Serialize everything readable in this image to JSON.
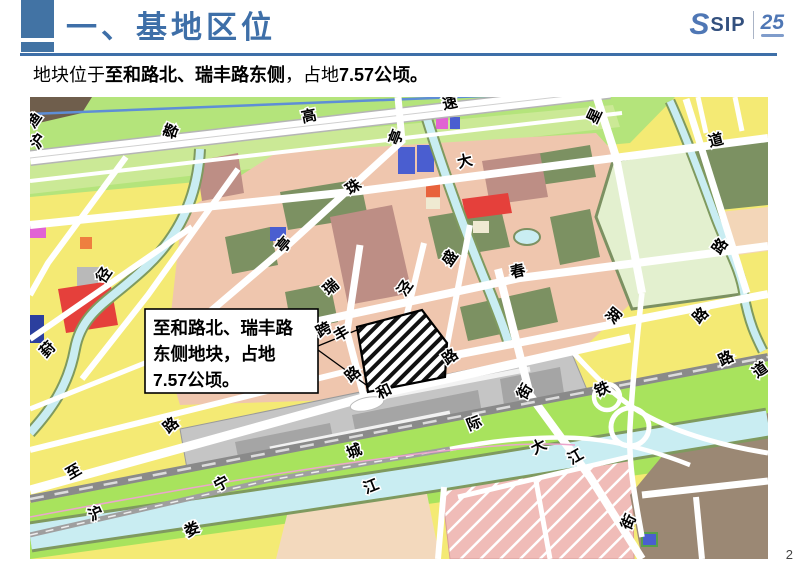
{
  "header": {
    "title": "一、基地区位"
  },
  "logo": {
    "s_mark": "S",
    "name": "SIP",
    "anniversary": "25"
  },
  "intro": {
    "prefix": "地块位于",
    "location": "至和路北、瑞丰路东侧",
    "mid": "，占地",
    "area": "7.57公顷。"
  },
  "callout": {
    "lines": [
      "至和路北、瑞丰路",
      "东侧地块，占地",
      "7.57公顷。"
    ]
  },
  "map": {
    "labels": [
      {
        "t": "渔",
        "x": 8,
        "y": 26,
        "r": -55
      },
      {
        "t": "沪",
        "x": 12,
        "y": 47,
        "r": -55
      },
      {
        "t": "蓉",
        "x": 146,
        "y": 36,
        "r": -70
      },
      {
        "t": "高",
        "x": 280,
        "y": 24,
        "r": -12
      },
      {
        "t": "速",
        "x": 421,
        "y": 11,
        "r": -12
      },
      {
        "t": "亭",
        "x": 371,
        "y": 42,
        "r": -70
      },
      {
        "t": "星",
        "x": 569,
        "y": 21,
        "r": -65
      },
      {
        "t": "大",
        "x": 436,
        "y": 69,
        "r": -14
      },
      {
        "t": "道",
        "x": 687,
        "y": 48,
        "r": -14
      },
      {
        "t": "珠",
        "x": 326,
        "y": 94,
        "r": -35
      },
      {
        "t": "径",
        "x": 78,
        "y": 181,
        "r": -55
      },
      {
        "t": "亭",
        "x": 258,
        "y": 151,
        "r": -50
      },
      {
        "t": "盛",
        "x": 424,
        "y": 164,
        "r": -55
      },
      {
        "t": "春",
        "x": 489,
        "y": 179,
        "r": -14
      },
      {
        "t": "瑞",
        "x": 304,
        "y": 194,
        "r": -40
      },
      {
        "t": "泾",
        "x": 379,
        "y": 194,
        "r": -55
      },
      {
        "t": "湖",
        "x": 588,
        "y": 222,
        "r": -50
      },
      {
        "t": "路",
        "x": 694,
        "y": 152,
        "r": -55
      },
      {
        "t": "跨",
        "x": 296,
        "y": 237,
        "r": -30
      },
      {
        "t": "丰",
        "x": 314,
        "y": 241,
        "r": -30
      },
      {
        "t": "葑",
        "x": 21,
        "y": 256,
        "r": -45
      },
      {
        "t": "路",
        "x": 326,
        "y": 281,
        "r": -40
      },
      {
        "t": "和",
        "x": 356,
        "y": 299,
        "r": -25
      },
      {
        "t": "路",
        "x": 423,
        "y": 264,
        "r": -35
      },
      {
        "t": "街",
        "x": 499,
        "y": 297,
        "r": -60
      },
      {
        "t": "路",
        "x": 674,
        "y": 222,
        "r": -45
      },
      {
        "t": "路",
        "x": 144,
        "y": 332,
        "r": -40
      },
      {
        "t": "至",
        "x": 46,
        "y": 379,
        "r": -30
      },
      {
        "t": "宁",
        "x": 194,
        "y": 391,
        "r": -28
      },
      {
        "t": "沪",
        "x": 68,
        "y": 421,
        "r": -25
      },
      {
        "t": "娄",
        "x": 164,
        "y": 437,
        "r": -25
      },
      {
        "t": "城",
        "x": 326,
        "y": 359,
        "r": -22
      },
      {
        "t": "际",
        "x": 446,
        "y": 331,
        "r": -22
      },
      {
        "t": "铁",
        "x": 574,
        "y": 297,
        "r": -22
      },
      {
        "t": "路",
        "x": 698,
        "y": 266,
        "r": -25
      },
      {
        "t": "道",
        "x": 733,
        "y": 277,
        "r": -35
      },
      {
        "t": "大",
        "x": 511,
        "y": 354,
        "r": -28
      },
      {
        "t": "江",
        "x": 343,
        "y": 394,
        "r": -22
      },
      {
        "t": "江",
        "x": 548,
        "y": 364,
        "r": -30
      },
      {
        "t": "街",
        "x": 603,
        "y": 427,
        "r": -65
      }
    ]
  },
  "colors": {
    "accent_blue": "#4273a4",
    "title_blue": "#3e6fa8",
    "map_water": "#c9edf2",
    "map_green_band": "#b4e47b",
    "map_corridor_green": "#a8e35d",
    "map_park": "#e3f0cf",
    "map_yellow": "#f4ea74",
    "map_salmon": "#efc6ae",
    "map_olive": "#7c9162",
    "map_station_gray": "#c5c5c5",
    "map_brown": "#9b8874",
    "target_hatch": "#111111"
  },
  "footer": {
    "page_number": "2"
  }
}
